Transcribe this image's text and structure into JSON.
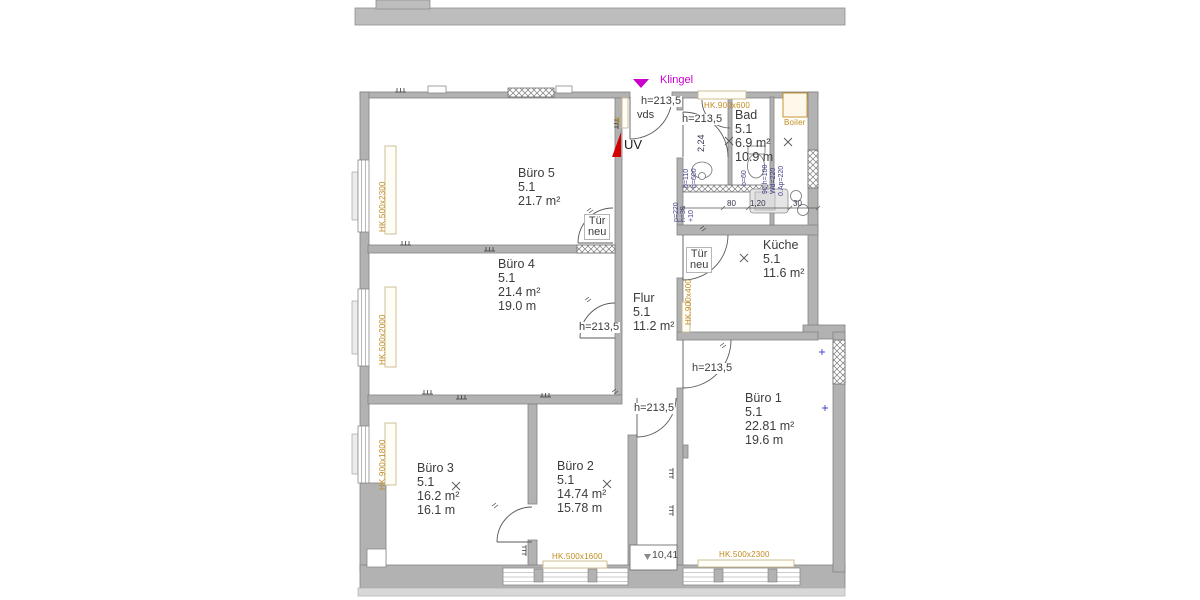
{
  "drawing": {
    "klingel": "Klingel",
    "uv": "UV",
    "vds": "vds",
    "door_height": "h=213,5",
    "tuer_line1": "Tür",
    "tuer_line2": "neu",
    "level_value": "10,41",
    "dim_224": "2,24"
  },
  "rooms": [
    {
      "name": "Büro 5",
      "nr": "5.1",
      "area": "21.7 m²",
      "extra": ""
    },
    {
      "name": "Büro 4",
      "nr": "5.1",
      "area": "21.4 m²",
      "extra": "19.0 m"
    },
    {
      "name": "Büro 3",
      "nr": "5.1",
      "area": "16.2 m²",
      "extra": "16.1 m"
    },
    {
      "name": "Büro 2",
      "nr": "5.1",
      "area": "14.74 m²",
      "extra": "15.78 m"
    },
    {
      "name": "Büro 1",
      "nr": "5.1",
      "area": "22.81 m²",
      "extra": "19.6 m"
    },
    {
      "name": "Bad",
      "nr": "5.1",
      "area": "6.9 m²",
      "extra": "10.9 m"
    },
    {
      "name": "Küche",
      "nr": "5.1",
      "area": "11.6 m²",
      "extra": ""
    },
    {
      "name": "Flur",
      "nr": "5.1",
      "area": "11.2 m²",
      "extra": ""
    }
  ],
  "radiators": {
    "left_top": "HK.500x2300",
    "left_mid": "HK.500x2000",
    "left_bottom": "HK.900x1800",
    "bad_top": "HK.900x600",
    "kueche": "HK.900x400",
    "buero2_bottom": "HK.500x1600",
    "buero1_bottom": "HK.500x2300",
    "flur_small": "HK",
    "boiler": "Boiler"
  },
  "bath_dims": {
    "d80": "80",
    "d120": "1,20",
    "d30": "30",
    "p220": "p=220",
    "h30": "h=30",
    "plus10": "+10",
    "b110": "b=110",
    "h600": "h=600",
    "b60": "b=60",
    "h100": "90 h=100",
    "wd220": "Wd=220",
    "ap220": "0.Ap=220"
  }
}
